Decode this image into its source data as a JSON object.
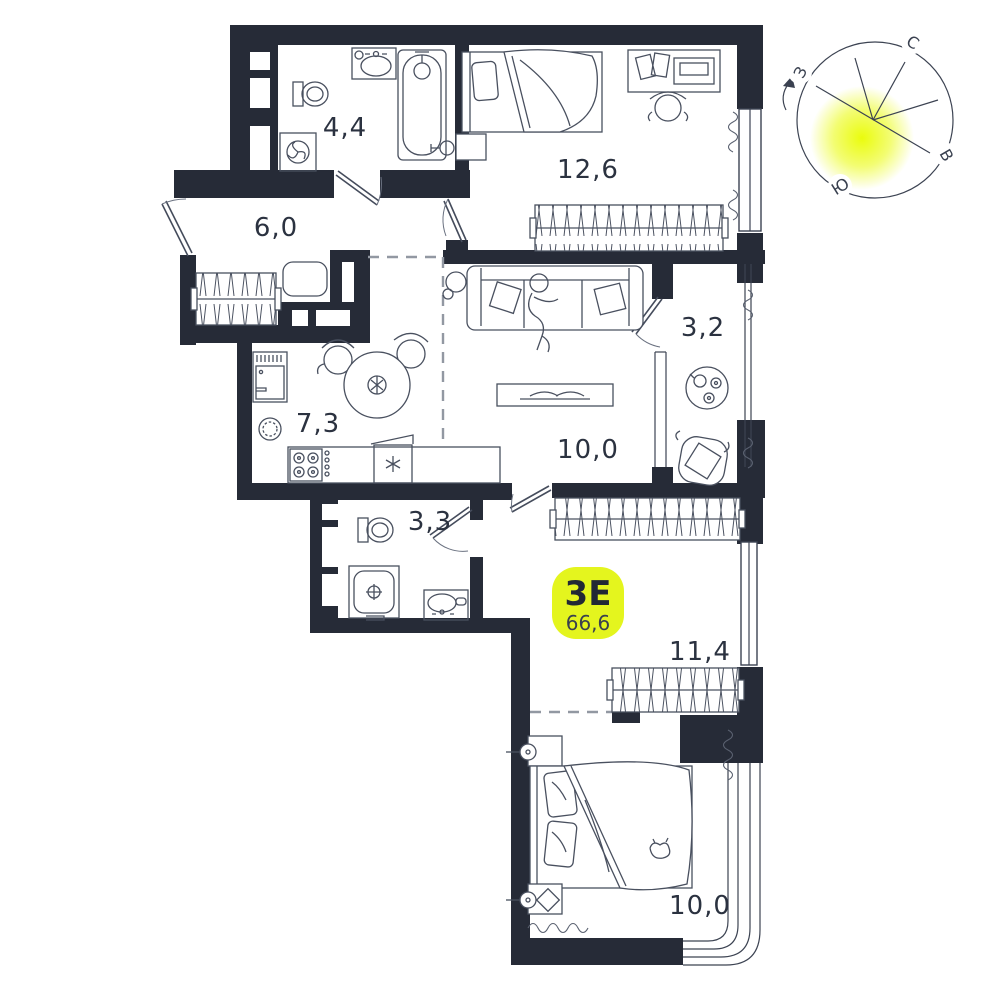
{
  "plan": {
    "apartment": {
      "type": "3Е",
      "area": "66,6"
    },
    "rooms": [
      {
        "id": "bathroom-top",
        "area": "4,4"
      },
      {
        "id": "bedroom-top",
        "area": "12,6"
      },
      {
        "id": "hallway",
        "area": "6,0"
      },
      {
        "id": "kitchen",
        "area": "7,3"
      },
      {
        "id": "living-room",
        "area": "10,0"
      },
      {
        "id": "loggia",
        "area": "3,2"
      },
      {
        "id": "bathroom-small",
        "area": "3,3"
      },
      {
        "id": "corridor",
        "area": "11,4"
      },
      {
        "id": "bedroom-bottom",
        "area": "10,0"
      }
    ],
    "compass": {
      "north": "С",
      "east": "В",
      "south": "Ю",
      "west": "З"
    },
    "colors": {
      "wall": "#262b37",
      "accent": "#e4f51e",
      "line": "#49505f",
      "text": "#2b3240"
    }
  }
}
